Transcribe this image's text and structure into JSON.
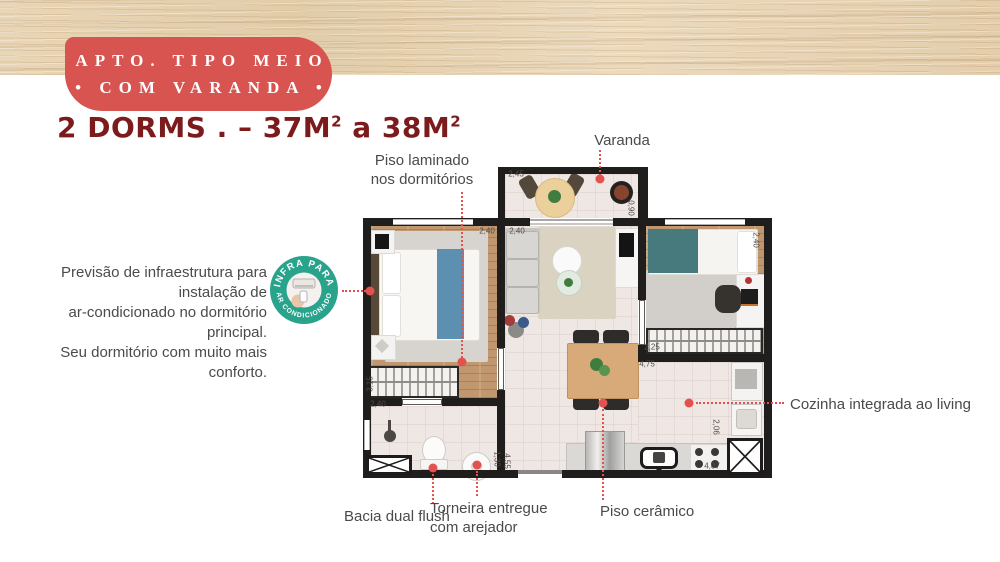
{
  "header": {
    "badge": {
      "line1": "APTO. TIPO MEIO",
      "line2": "• COM VARANDA •"
    },
    "title": {
      "p1": "2 DORMS . – 37M",
      "sup1": "2",
      "p2": " a 38M",
      "sup2": "2"
    }
  },
  "annotations": {
    "flooring": {
      "line1": "Piso laminado",
      "line2": "nos dormitórios"
    },
    "balcony_label": "Varanda",
    "infra_note": {
      "line1": "Previsão de infraestrutura para instalação de",
      "line2": "ar-condicionado no dormitório principal.",
      "line3": "Seu dormitório com muito mais conforto."
    },
    "infra_badge": {
      "top": "INFRA PARA",
      "bottom": "AR CONDICIONADO"
    },
    "kitchen_label": "Cozinha integrada ao living",
    "toilet_label": "Bacia dual flush",
    "faucet_label": {
      "line1": "Torneira entregue",
      "line2": "com arejador"
    },
    "ceramic_label": "Piso cerâmico"
  },
  "dims": [
    "2,45",
    "0,90",
    "2,40",
    "2,40",
    "2,40",
    "2,25",
    "4,75",
    "3,15",
    "2,40",
    "1,30",
    "4,55",
    "2,06",
    "4,07"
  ],
  "colors": {
    "badge_red": "#d85450",
    "title_maroon": "#7b1b1b",
    "leader_red": "#e2534f",
    "infra_green": "#2aa38c",
    "wall_black": "#201d1d"
  }
}
